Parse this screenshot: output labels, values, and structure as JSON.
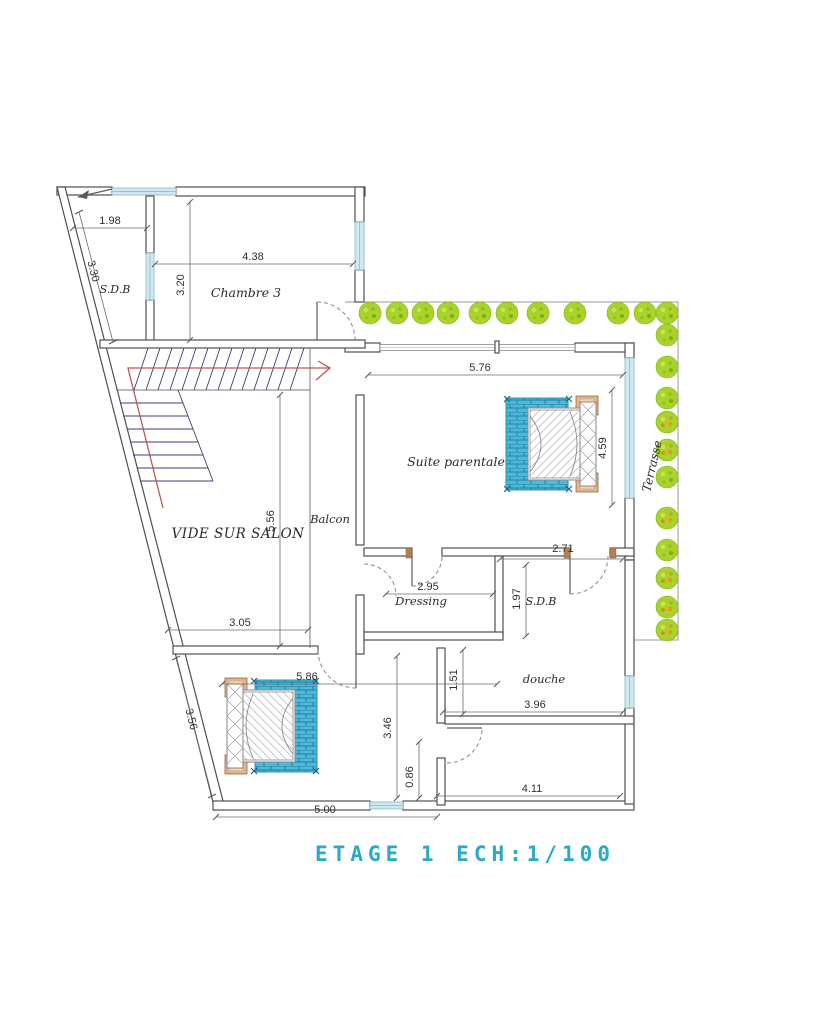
{
  "title": "ETAGE 1 ECH:1/100",
  "rooms": {
    "sdb_top": "S.D.B",
    "chambre3": "Chambre 3",
    "suite": "Suite parentale",
    "vide": "VIDE SUR SALON",
    "balcon": "Balcon",
    "dressing": "Dressing",
    "sdb_right": "S.D.B",
    "douche": "douche",
    "terrasse": "Terrasse"
  },
  "dims": {
    "sdb_width": "1.98",
    "sdb_slant": "3.30",
    "chambre3_height": "3.20",
    "chambre3_width": "4.38",
    "suite_width": "5.76",
    "suite_height": "4.59",
    "vide_height": "5.56",
    "vide_width": "3.05",
    "dressing_width": "2.95",
    "sdb2_width": "2.71",
    "sdb2_height": "1.97",
    "douche_offset": "1.51",
    "douche_width": "3.96",
    "bedroom_width": "5.86",
    "bedroom_slant": "3.56",
    "bedroom_height": "3.46",
    "door_offset": "0.86",
    "bottom_width": "5.00",
    "bottom_room_width": "4.11"
  },
  "colors": {
    "title": "#2ba9c9",
    "tree": "#a9d32b",
    "rug": "#4fb9d8",
    "stair_direction_line": "#bf5552",
    "window_glass": "#cfe8f1",
    "wall_outline": "#4f4f4f",
    "nightstand_wood": "#e2b488"
  }
}
